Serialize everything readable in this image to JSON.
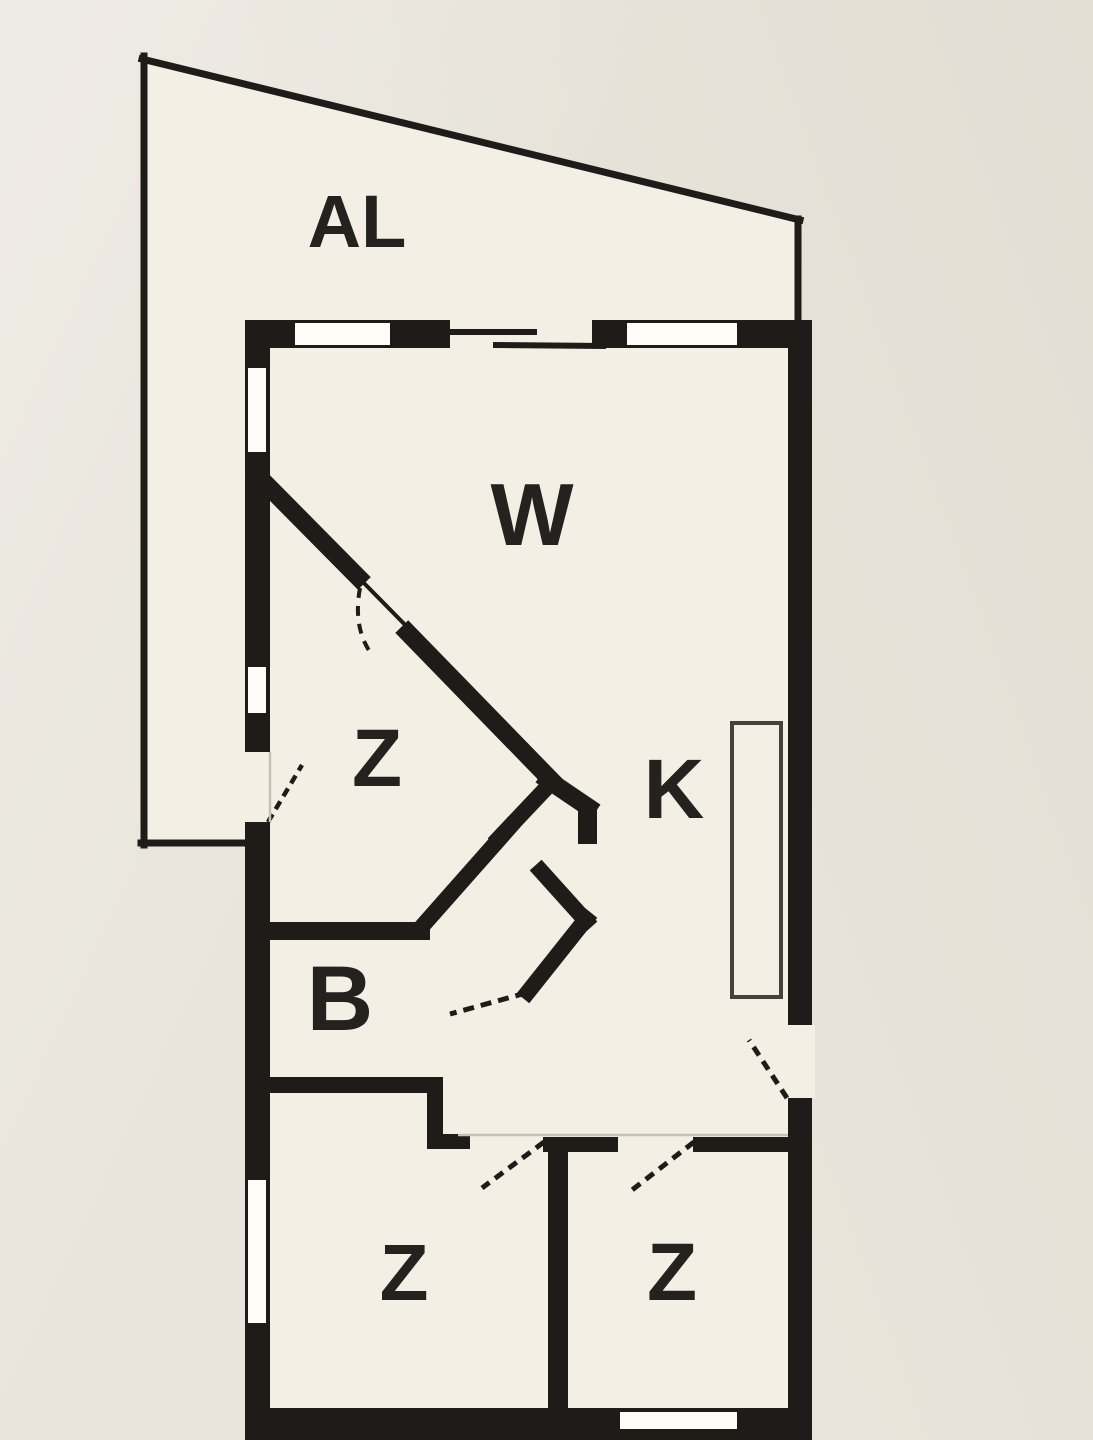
{
  "document": {
    "kind": "apartment floor plan (scanned)",
    "colors": {
      "paper": "#e9e5dc",
      "plan_interior": "#f3efe5",
      "ink": "#1d1c19",
      "faint_line": "#c6c1b2",
      "label_ink": "#23221e"
    }
  },
  "rooms": [
    {
      "id": "al",
      "label": "AL",
      "meaning": "balcony / terrace"
    },
    {
      "id": "w",
      "label": "W",
      "meaning": "living room"
    },
    {
      "id": "z1",
      "label": "Z",
      "meaning": "room (middle)"
    },
    {
      "id": "k",
      "label": "K",
      "meaning": "kitchen"
    },
    {
      "id": "b",
      "label": "B",
      "meaning": "bathroom"
    },
    {
      "id": "z2",
      "label": "Z",
      "meaning": "room (bottom left)"
    },
    {
      "id": "z3",
      "label": "Z",
      "meaning": "room (bottom right)"
    }
  ]
}
